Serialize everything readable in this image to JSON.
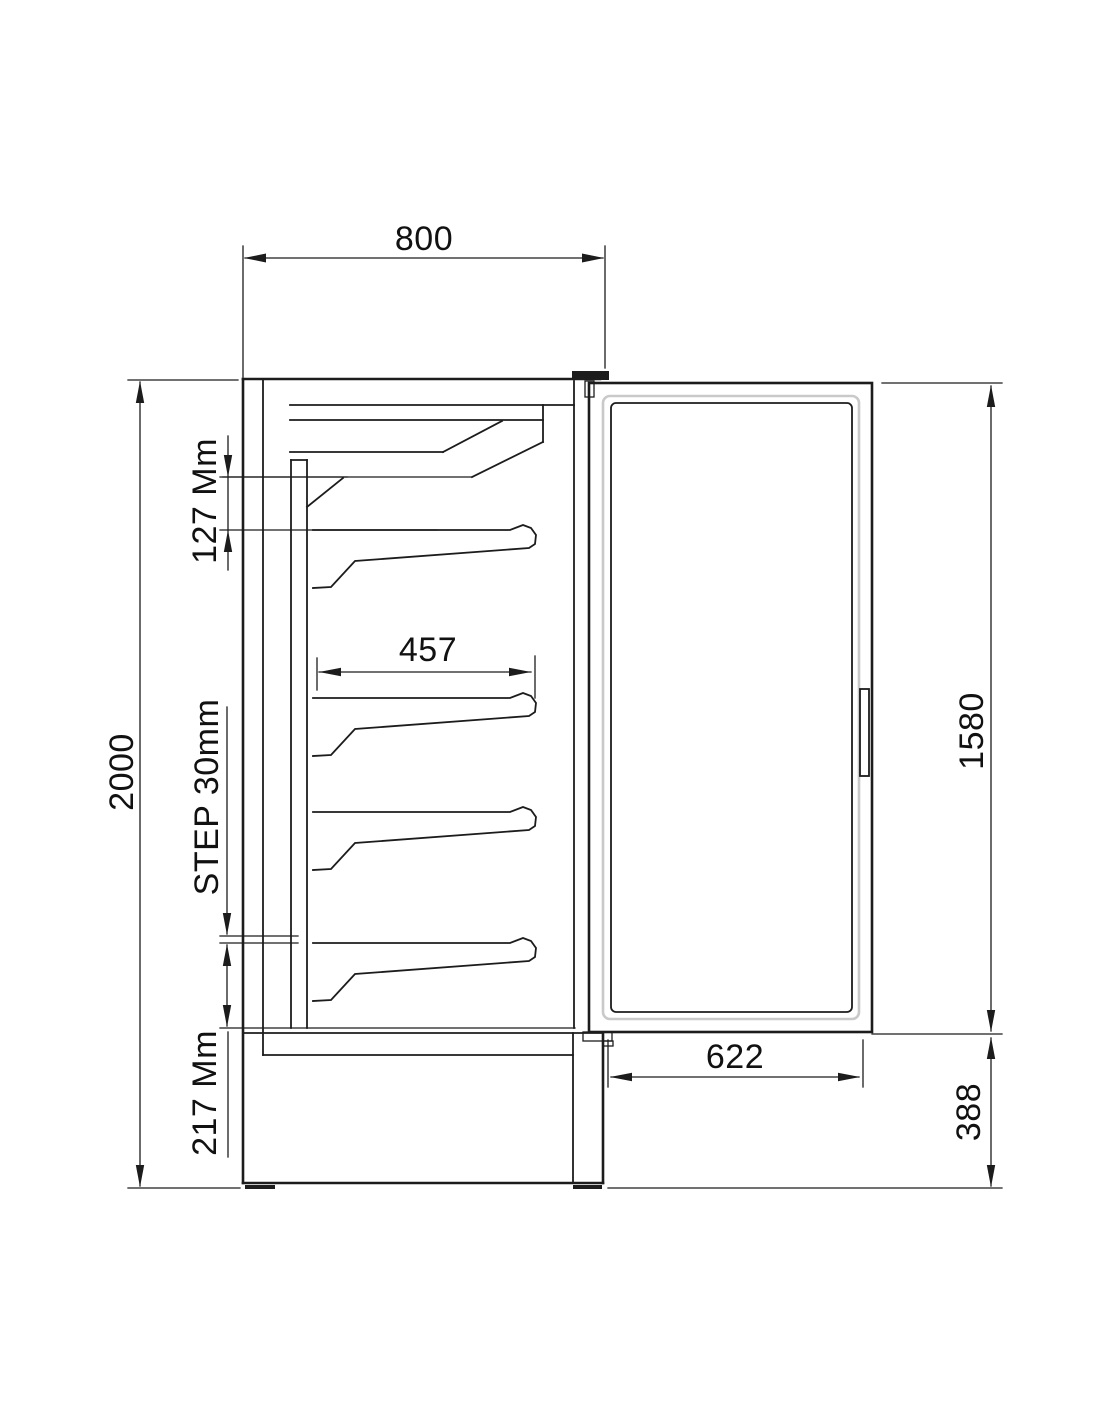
{
  "drawing": {
    "labels": {
      "top_width": "800",
      "overall_height": "2000",
      "canopy_shelf_gap": "127 Mm",
      "shelf_depth": "457",
      "shelf_step": "STEP 30mm",
      "bottom_section": "217 Mm",
      "door_height": "1580",
      "door_width": "622",
      "base_height": "388"
    },
    "colors": {
      "line": "#1c1c1c",
      "text": "#111111",
      "glass_edge": "#c9c9c9",
      "background": "#ffffff"
    }
  }
}
